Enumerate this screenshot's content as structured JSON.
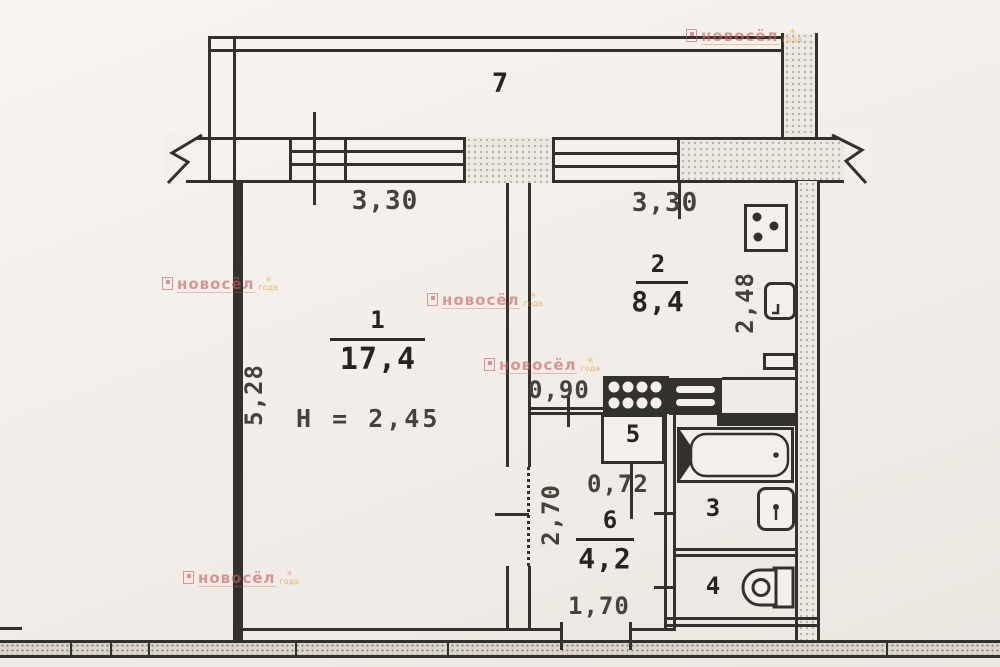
{
  "plan": {
    "rooms": {
      "balcony": {
        "number": "7"
      },
      "living": {
        "number": "1",
        "area": "17,4",
        "height": "H = 2,45"
      },
      "kitchen": {
        "number": "2",
        "area": "8,4"
      },
      "closet": {
        "number": "5"
      },
      "bath": {
        "number": "3"
      },
      "wc": {
        "number": "4"
      },
      "hall": {
        "number": "6",
        "area": "4,2"
      }
    },
    "dimensions": {
      "window_left": "3,30",
      "window_right": "3,30",
      "living_depth": "5,28",
      "kitchen_depth": "2,48",
      "kitchen_door": "0,90",
      "closet_width": "0,72",
      "hall_depth": "2,70",
      "entry_width": "1,70"
    },
    "icons": {
      "stove": "stove-icon",
      "kitchen_sink": "sink-icon",
      "bathtub": "bathtub-icon",
      "wash_basin": "wash-basin-icon",
      "toilet": "toilet-icon",
      "vent_round": "vent-shaft-round-icon",
      "vent_lined": "vent-shaft-lined-icon"
    },
    "colors": {
      "paper": "#f3efeb",
      "ink": "#33312d",
      "stipple": "#b7b0a6",
      "watermark_red": "#c75f5f",
      "watermark_orange": "#d89a2a"
    }
  },
  "watermark": {
    "brand": "новосёл",
    "star": "✳",
    "sub": "года"
  }
}
